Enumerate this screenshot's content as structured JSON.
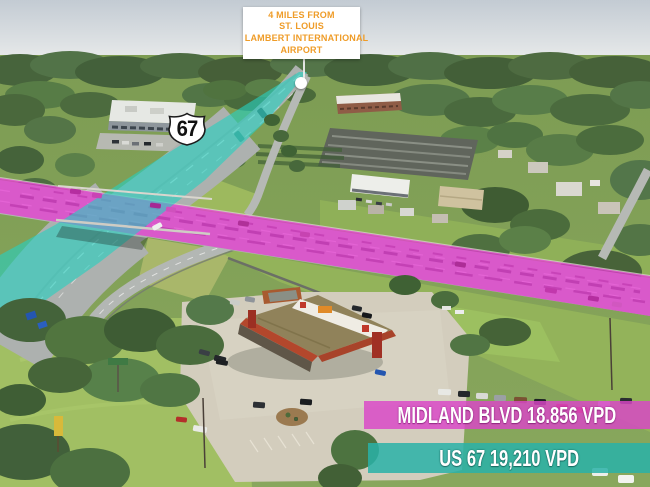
{
  "callout": {
    "lines": [
      "4 MILES FROM",
      "ST. LOUIS",
      "LAMBERT INTERNATIONAL",
      "AIRPORT"
    ],
    "text_color": "#EF9C28",
    "marker": "location-dot"
  },
  "route_shield": {
    "number": "67"
  },
  "traffic_labels": {
    "midland": {
      "text": "MIDLAND BLVD 18.856 VPD",
      "road": "MIDLAND BLVD",
      "value": "18.856",
      "unit": "VPD",
      "bg_color": "#DB46C8"
    },
    "us67": {
      "text": "US 67 19,210 VPD",
      "road": "US 67",
      "value": "19,210",
      "unit": "VPD",
      "bg_color": "#29B2A8"
    }
  },
  "highlights": {
    "midland_blvd_color": "#E23AD2",
    "us67_color": "#26D0C0"
  }
}
